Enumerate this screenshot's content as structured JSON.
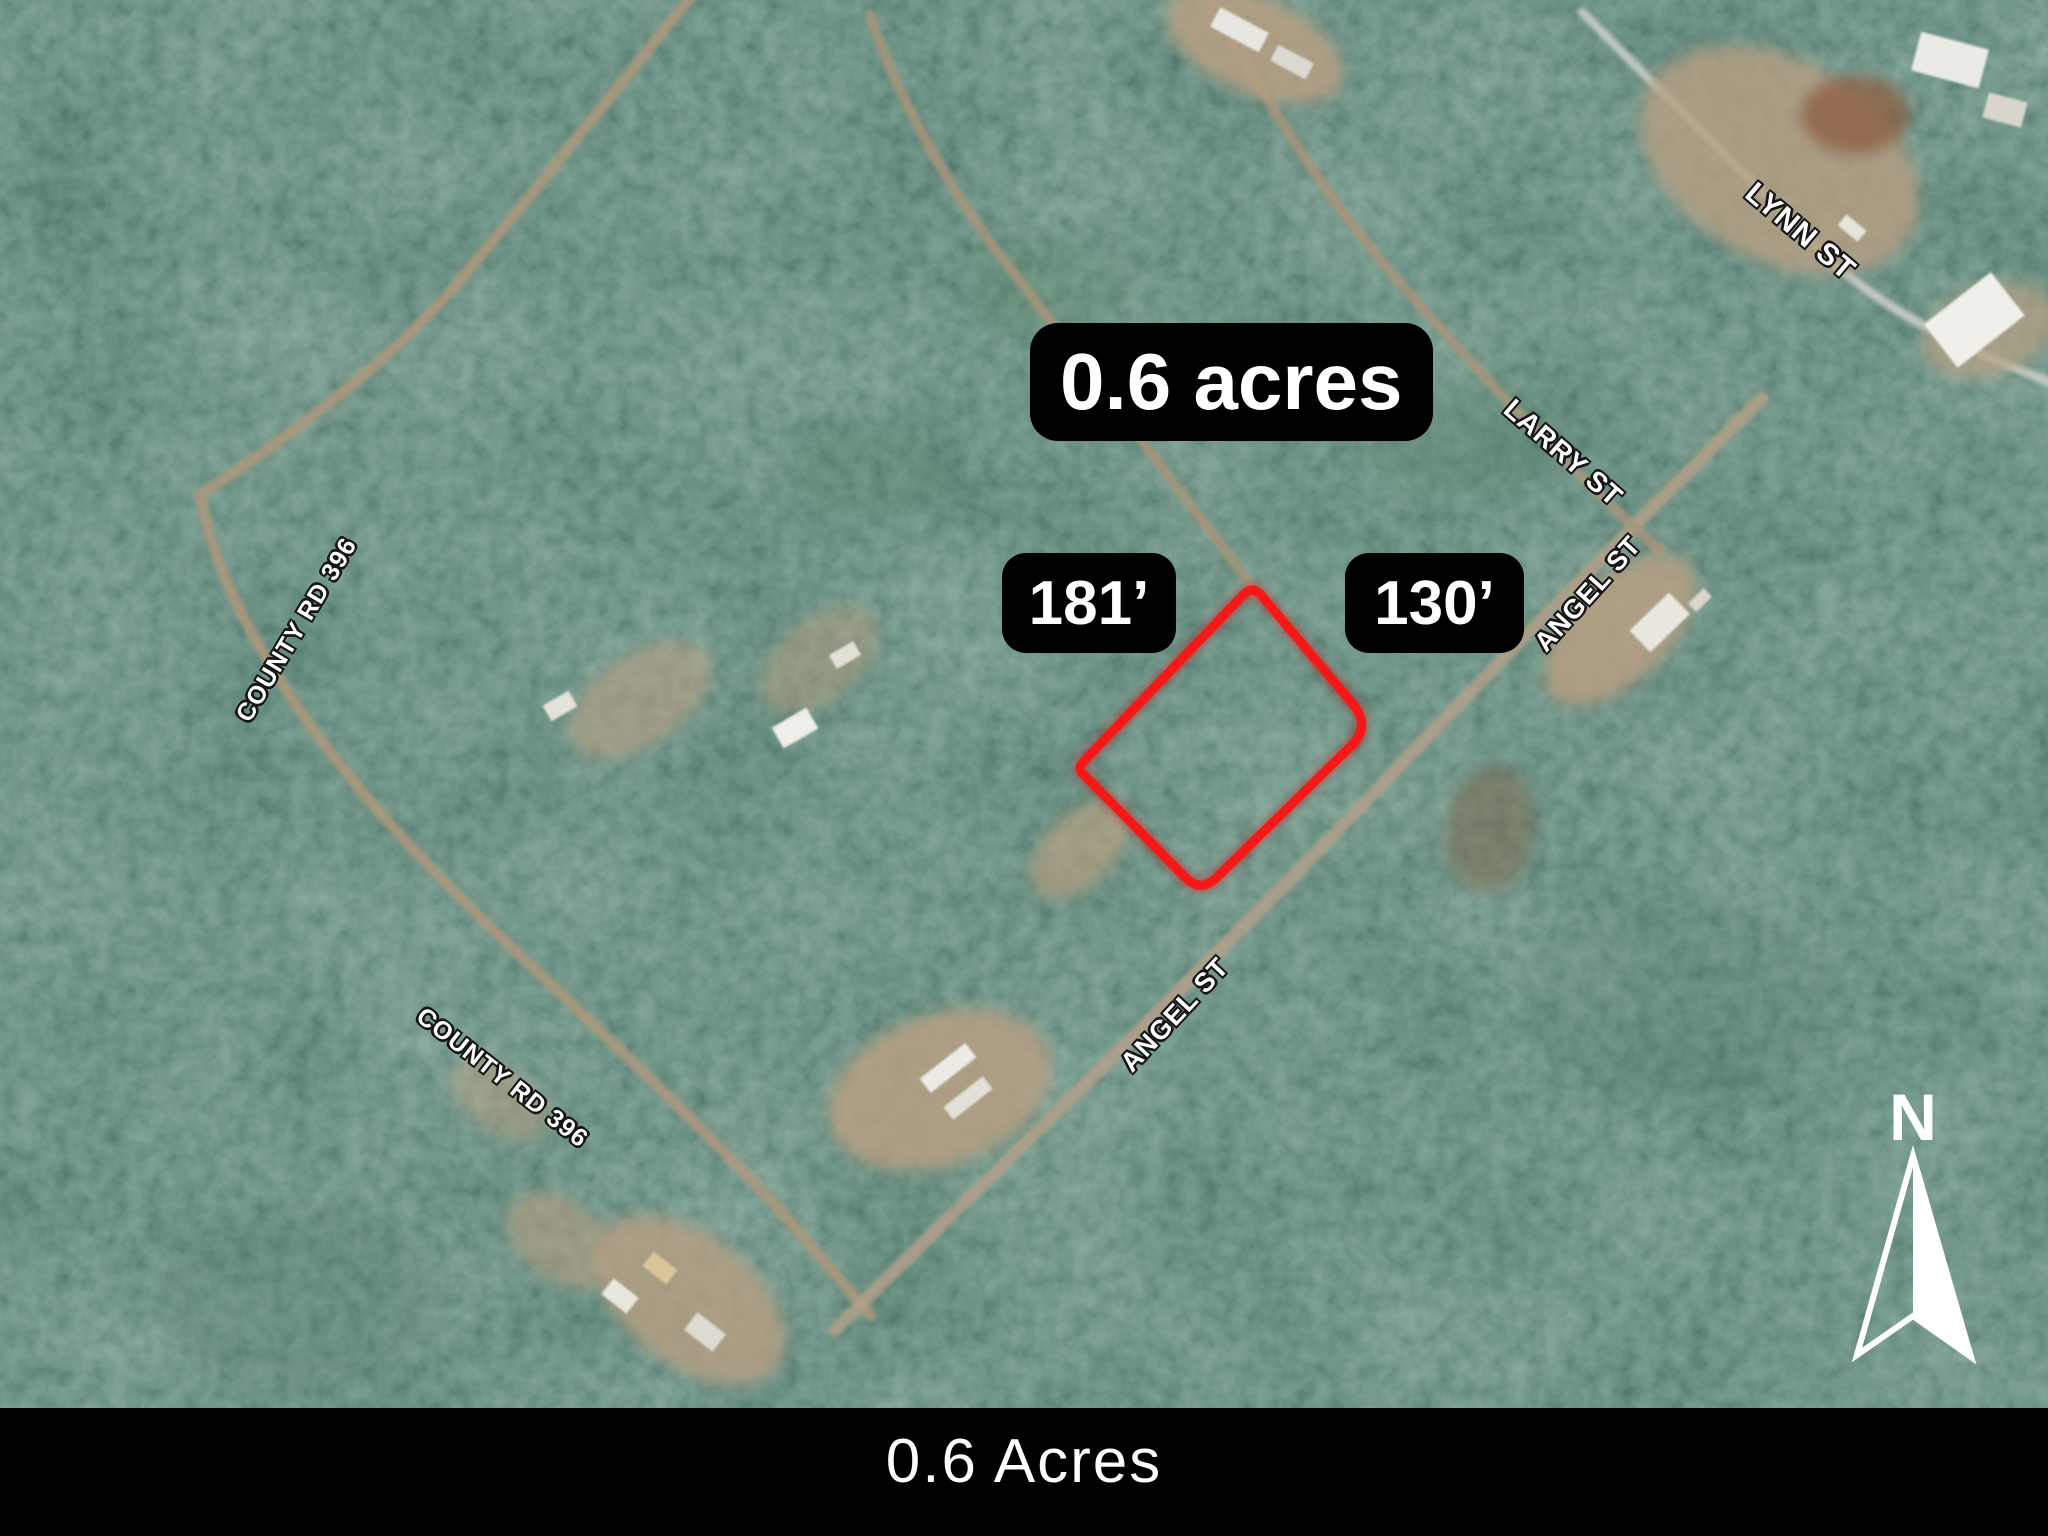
{
  "map": {
    "badges": {
      "area": "0.6 acres",
      "dim_left": "181’",
      "dim_right": "130’"
    },
    "street_labels": [
      {
        "id": "lynn-st",
        "text": "LYNN ST"
      },
      {
        "id": "larry-st",
        "text": "LARRY ST"
      },
      {
        "id": "angel-st-upper",
        "text": "ANGEL ST"
      },
      {
        "id": "angel-st-lower",
        "text": "ANGEL ST"
      },
      {
        "id": "county-rd-396-west",
        "text": "COUNTY RD 396"
      },
      {
        "id": "county-rd-396-south",
        "text": "COUNTY RD 396"
      }
    ],
    "compass": {
      "label": "N"
    },
    "parcel": {
      "area": "0.6 acres",
      "side_left": "181’",
      "side_right": "130’",
      "outline_color": "#f81616"
    }
  },
  "caption": {
    "text": "0.6 Acres"
  },
  "colors": {
    "forest_base": "#2b473f",
    "road": "#ab987d",
    "badge_bg": "#000000",
    "badge_text": "#ffffff",
    "caption_bg": "#000000",
    "caption_text": "#ffffff",
    "parcel_outline": "#f81616"
  }
}
